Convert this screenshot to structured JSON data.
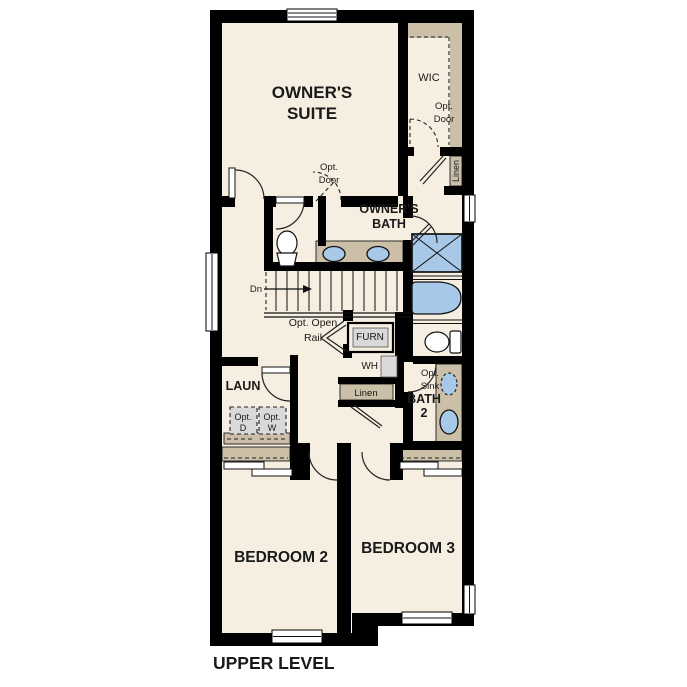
{
  "title": "UPPER LEVEL",
  "colors": {
    "floor": "#f6eee0",
    "wall": "#000000",
    "shelf": "#cbbfa7",
    "fixture": "#a8c8e8",
    "appliance": "#d9d9d9"
  },
  "labels": {
    "owners_suite": [
      "OWNER'S",
      "SUITE"
    ],
    "wic": "WIC",
    "wic_opt_door": [
      "Opt.",
      "Door"
    ],
    "wic_linen": "Linen",
    "suite_opt_door": [
      "Opt.",
      "Door"
    ],
    "owners_bath": [
      "OWNER'S",
      "BATH"
    ],
    "stairs_dn": "Dn",
    "stairs_opt_open_rail": [
      "Opt. Open",
      "Rail"
    ],
    "furnace": "FURN",
    "water_heater": "WH",
    "hall_linen": "Linen",
    "laundry": "LAUN",
    "opt_dryer": [
      "Opt.",
      "D"
    ],
    "opt_washer": [
      "Opt.",
      "W"
    ],
    "opt_sink": [
      "Opt.",
      "Sink"
    ],
    "bath_2": [
      "BATH",
      "2"
    ],
    "bedroom_2": "BEDROOM 2",
    "bedroom_3": "BEDROOM 3"
  }
}
